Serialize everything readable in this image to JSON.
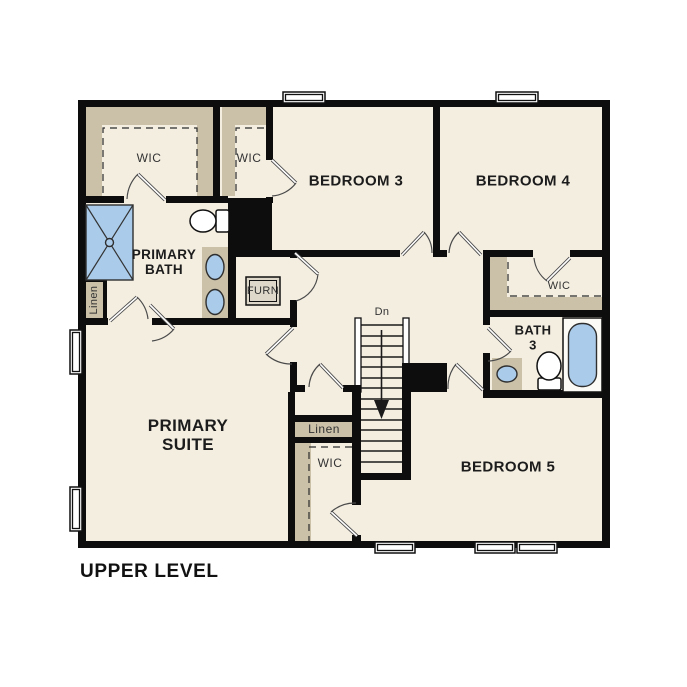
{
  "title": {
    "label": "UPPER LEVEL"
  },
  "colors": {
    "wall": "#0d0d0d",
    "floor": "#f4eee1",
    "closet": "#cbc1a9",
    "fixture": "#aacbea",
    "paper": "#ffffff"
  },
  "labels": {
    "wic_primary": "WIC",
    "wic_bedroom3": "WIC",
    "bedroom3": "BEDROOM 3",
    "bedroom4": "BEDROOM 4",
    "primary_bath": "PRIMARY BATH",
    "linen_bath": "Linen",
    "furnace": "FURN",
    "wic_bedroom4": "WIC",
    "bath3": "BATH 3",
    "stairs_down": "Dn",
    "linen_hall": "Linen",
    "wic_bedroom5": "WIC",
    "primary_suite": "PRIMARY SUITE",
    "bedroom5": "BEDROOM 5"
  }
}
